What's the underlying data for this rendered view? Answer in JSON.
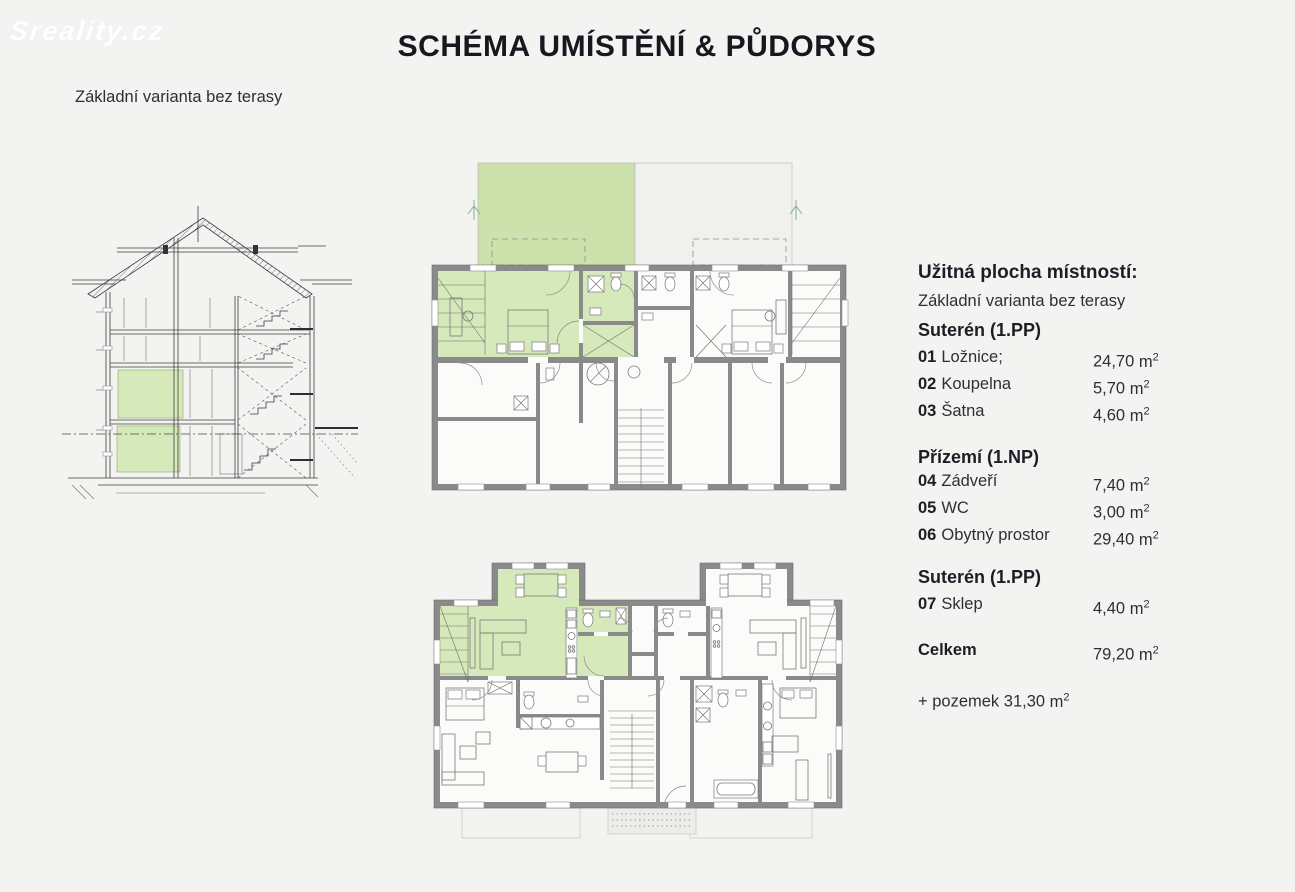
{
  "header": {
    "logo": "Sreality.cz",
    "title": "SCHÉMA UMÍSTĚNÍ & PŮDORYS",
    "subtitle": "Základní varianta bez terasy"
  },
  "panel": {
    "heading": "Užitná plocha místností:",
    "subheading": "Základní varianta bez terasy",
    "units": {
      "base": "m",
      "exp": "2"
    },
    "sections": [
      {
        "title": "Suterén (1.PP)",
        "rows": [
          {
            "num": "01",
            "label": "Ložnice;",
            "area": "24,70"
          },
          {
            "num": "02",
            "label": "Koupelna",
            "area": "5,70"
          },
          {
            "num": "03",
            "label": "Šatna",
            "area": "4,60"
          }
        ]
      },
      {
        "title": "Přízemí (1.NP)",
        "rows": [
          {
            "num": "04",
            "label": "Zádveří",
            "area": "7,40"
          },
          {
            "num": "05",
            "label": "WC",
            "area": "3,00"
          },
          {
            "num": "06",
            "label": "Obytný prostor",
            "area": "29,40"
          }
        ]
      },
      {
        "title": "Suterén (1.PP)",
        "rows": [
          {
            "num": "07",
            "label": "Sklep",
            "area": "4,40"
          }
        ]
      }
    ],
    "total": {
      "label": "Celkem",
      "area": "79,20"
    },
    "addition": {
      "label": "+ pozemek",
      "area": "31,30"
    }
  },
  "colors": {
    "background": "#f3f3f1",
    "highlight_green": "#d6e9ba",
    "garden_green": "#cde1ac",
    "wall_gray": "#8a8a8a",
    "title_text": "#17171f",
    "body_text": "#2e2e36"
  }
}
